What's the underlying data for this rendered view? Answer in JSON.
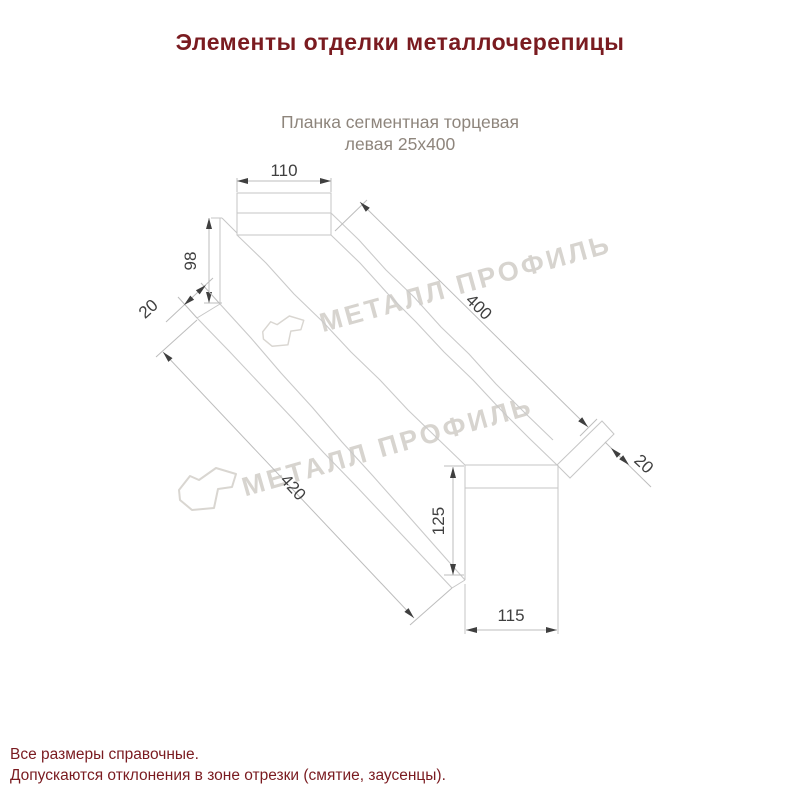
{
  "header": {
    "title": "Элементы отделки металлочерепицы",
    "title_color": "#7a1b20"
  },
  "subtitle": {
    "line1": "Планка сегментная торцевая",
    "line2": "левая 25х400",
    "color": "#8e857c"
  },
  "drawing": {
    "type": "technical-line-drawing",
    "dimensions": {
      "top_width": "110",
      "profile_height": "98",
      "left_flange_width": "20",
      "segment_length_top": "400",
      "right_flange_width": "20",
      "segment_length_bottom": "420",
      "end_height": "125",
      "end_width": "115"
    },
    "line_color": "#c6c6c6",
    "dim_text_color": "#3f3f3f"
  },
  "watermark": {
    "text": "МЕТАЛЛ ПРОФИЛЬ",
    "color": "#d7d4cf"
  },
  "footer": {
    "line1": "Все размеры справочные.",
    "line2": "Допускаются отклонения в зоне отрезки (смятие, заусенцы).",
    "color": "#7a1b20"
  }
}
